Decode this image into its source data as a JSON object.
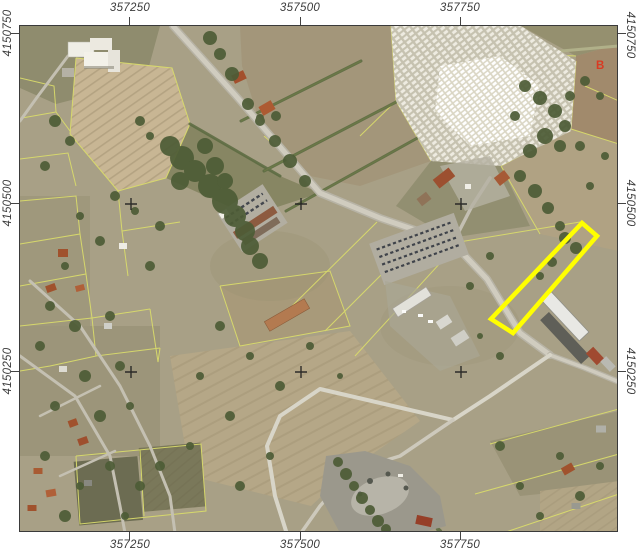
{
  "axes": {
    "top": [
      "357250",
      "357500",
      "357750"
    ],
    "bottom": [
      "357250",
      "357500",
      "357750"
    ],
    "left": [
      "4150750",
      "4150500",
      "4150250"
    ],
    "right": [
      "4150750",
      "4150500",
      "4150250"
    ]
  },
  "markers": {
    "b_label": "B"
  },
  "colors": {
    "highlight_outline": "#ffff00",
    "marker_b": "#d93a22",
    "parcel_line": "#d9db6b",
    "axis_text": "#3b3b3b",
    "map_border": "#3a3a3a",
    "tick": "#444444"
  }
}
